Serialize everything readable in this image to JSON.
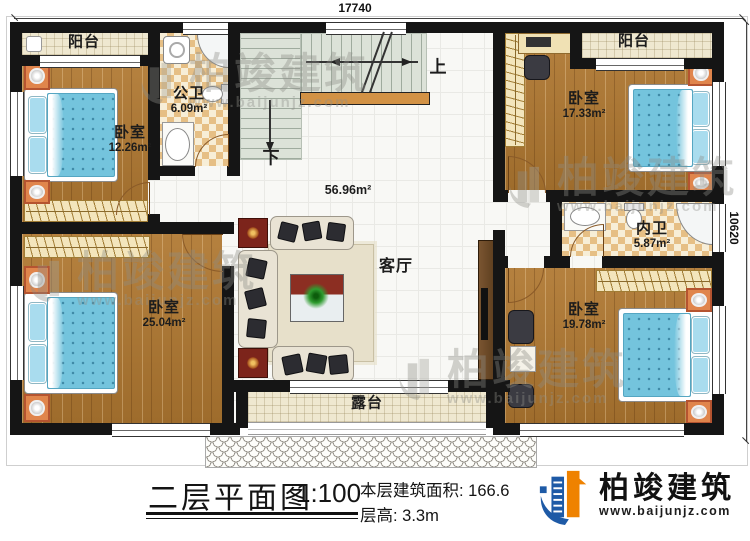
{
  "plan": {
    "dimensions": {
      "width": "17740",
      "height": "10620"
    },
    "stairs": {
      "up": "上",
      "down": "下"
    },
    "rooms": [
      {
        "id": "balcony-left",
        "name": "阳台"
      },
      {
        "id": "bedroom-top-left",
        "name": "卧室",
        "area": "12.26m²"
      },
      {
        "id": "bath-public",
        "name": "公卫",
        "area": "6.09m²"
      },
      {
        "id": "living-room",
        "name": "客厅",
        "area": "56.96m²"
      },
      {
        "id": "bedroom-top-right",
        "name": "卧室",
        "area": "17.33m²"
      },
      {
        "id": "bath-ensuite",
        "name": "内卫",
        "area": "5.87m²"
      },
      {
        "id": "bedroom-bottom-left",
        "name": "卧室",
        "area": "25.04m²"
      },
      {
        "id": "bedroom-bottom-right",
        "name": "卧室",
        "area": "19.78m²"
      },
      {
        "id": "balcony-right",
        "name": "阳台"
      },
      {
        "id": "terrace",
        "name": "露台"
      }
    ]
  },
  "title_block": {
    "plan_title": "二层平面图",
    "scale": "1:100",
    "floor_area": "本层建筑面积: 166.6",
    "floor_height": "层高: 3.3m"
  },
  "brand": {
    "name": "柏竣建筑",
    "website": "www.baijunjz.com"
  },
  "watermark": {
    "name": "柏竣建筑",
    "website": "www.baijunjz.com"
  },
  "colors": {
    "wall": "#151515",
    "wood_floor": "#a97636",
    "tile_checker": "#e6bf85",
    "mattress": "#74c4dd",
    "stair": "#dce2d8",
    "railing": "#d29245",
    "brand_blue": "#1e5aa6",
    "brand_orange": "#ef8200"
  }
}
